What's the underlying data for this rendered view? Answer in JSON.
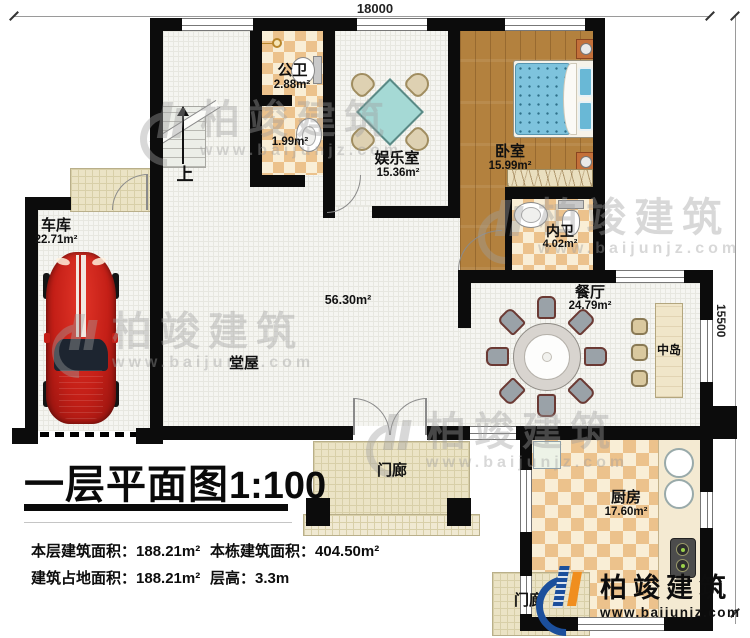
{
  "plan": {
    "title": "一层平面图",
    "scale": "1:100",
    "dim_top": "18000",
    "dim_right": "15500",
    "up_label": "上"
  },
  "rooms": {
    "garage": {
      "name": "车库",
      "area": "22.71m²"
    },
    "public_bath": {
      "name": "公卫",
      "area": "2.88m²"
    },
    "wash_area": {
      "area": "1.99m²"
    },
    "entertainment": {
      "name": "娱乐室",
      "area": "15.36m²"
    },
    "bedroom": {
      "name": "卧室",
      "area": "15.99m²"
    },
    "ensuite_bath": {
      "name": "内卫",
      "area": "4.02m²"
    },
    "dining": {
      "name": "餐厅",
      "area": "24.79m²"
    },
    "island": {
      "name": "中岛"
    },
    "hall": {
      "name": "堂屋",
      "area": "56.30m²"
    },
    "kitchen": {
      "name": "厨房",
      "area": "17.60m²"
    },
    "front_porch": {
      "name": "门廊"
    },
    "back_porch": {
      "name": "门廊"
    }
  },
  "stats": {
    "floor_area": {
      "label": "本层建筑面积：",
      "value": "188.21m²"
    },
    "building_area": {
      "label": "本栋建筑面积：",
      "value": "404.50m²"
    },
    "footprint_area": {
      "label": "建筑占地面积：",
      "value": "188.21m²"
    },
    "floor_height": {
      "label": "层高：",
      "value": "3.3m"
    }
  },
  "branding": {
    "name": "柏竣建筑",
    "url": "www.baijunjz.com"
  }
}
